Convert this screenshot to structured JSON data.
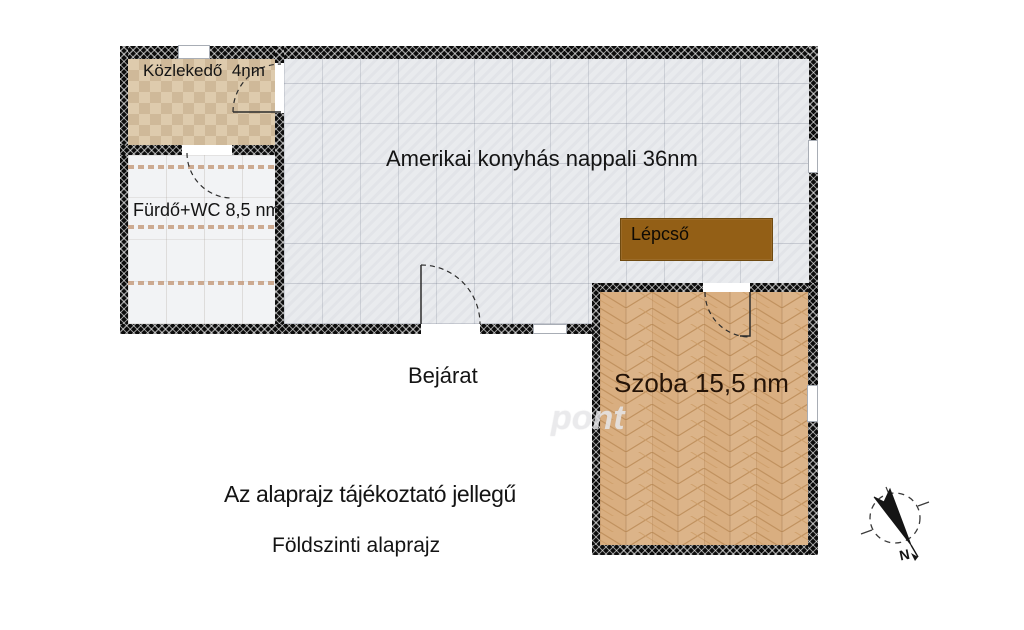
{
  "plan": {
    "rooms": {
      "kozlekedo": {
        "label": "Közlekedő  4nm"
      },
      "furdo": {
        "label": "Fürdő+WC 8,5 nm"
      },
      "nappali": {
        "label": "Amerikai konyhás nappali 36nm"
      },
      "szoba": {
        "label": "Szoba 15,5 nm"
      },
      "lepcso": {
        "label": "Lépcső"
      }
    },
    "entrance_label": "Bejárat",
    "disclaimer": "Az alaprajz tájékoztató jellegű",
    "floor_name": "Földszinti alaprajz",
    "compass_letter": "N",
    "watermark": "pont",
    "colors": {
      "wall": "#0c0c0c",
      "stairs_brown": "#935f16",
      "parquet_wood": "#d9ae80",
      "tile_beige": "#ddc9a9",
      "tile_gray": "#e9ebee",
      "bath_white": "#f2f3f5"
    }
  }
}
